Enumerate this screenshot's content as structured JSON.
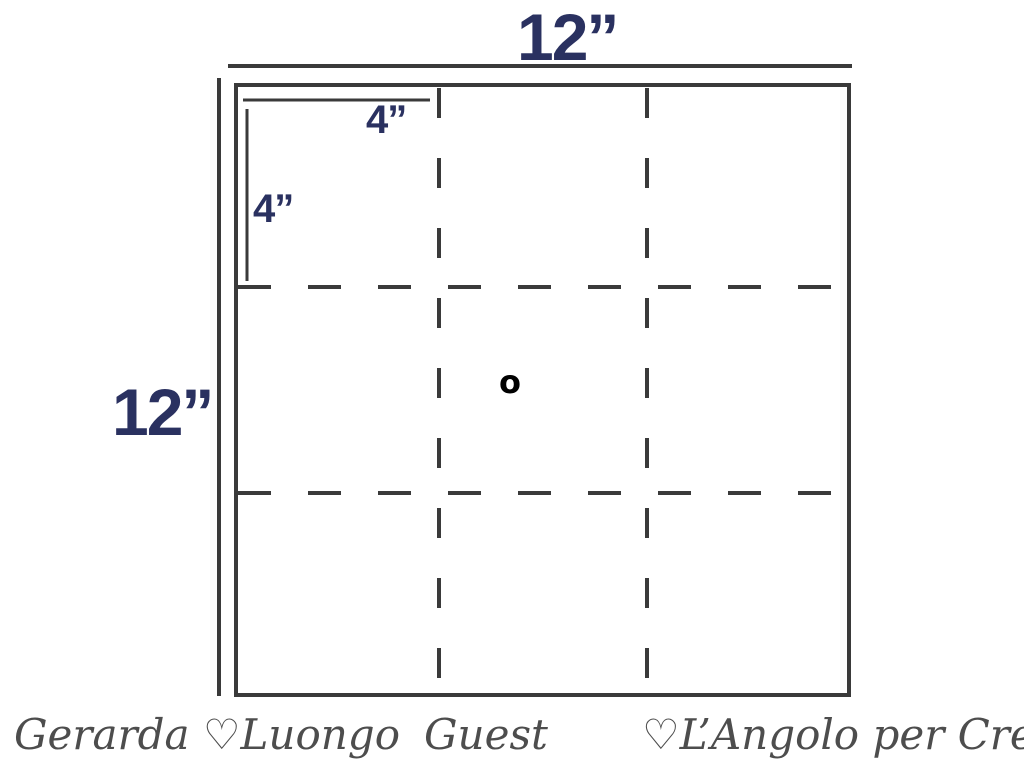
{
  "diagram": {
    "top_width_label": "12”",
    "left_height_label": "12”",
    "inner_width_label": "4”",
    "inner_height_label": "4”",
    "center_mark": "o",
    "description": "12 inch square divided by dashed fold lines into a 3x3 grid of 4 inch cells"
  },
  "footer": {
    "left_signature": "Gerarda ♡Luongo",
    "center_signature": "Guest",
    "right_signature": "♡L’Angolo per Creare"
  },
  "colors": {
    "dimension_text": "#2a3160",
    "line": "#3a3a3a",
    "signature_text": "#4d4d4d",
    "center_mark": "#000000",
    "background": "#ffffff"
  }
}
